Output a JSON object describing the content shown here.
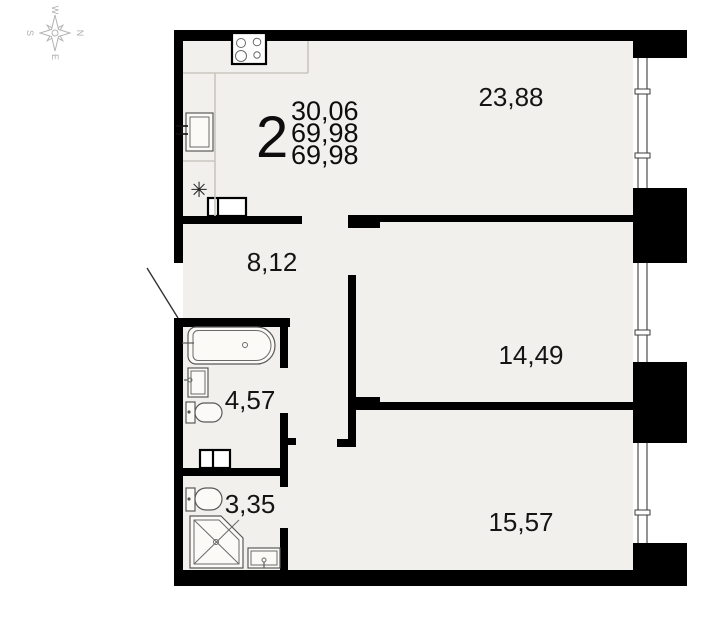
{
  "plan": {
    "title": "apartment-floor-plan",
    "apartment": {
      "rooms_count": "2",
      "living_area": "30,06",
      "total_area": "69,98",
      "total_area_with_balcony": "69,98"
    },
    "rooms": [
      {
        "id": "kitchen-living-room",
        "area": "23,88"
      },
      {
        "id": "hallway",
        "area": "8,12"
      },
      {
        "id": "bedroom-1",
        "area": "14,49"
      },
      {
        "id": "bedroom-2",
        "area": "15,57"
      },
      {
        "id": "bathroom",
        "area": "4,57"
      },
      {
        "id": "wc-shower-room",
        "area": "3,35"
      }
    ],
    "kitchen": {
      "fridge_symbol": "✳"
    },
    "compass": {
      "north": "N",
      "south": "S",
      "west": "W",
      "east": "E"
    },
    "colors": {
      "wall": "#000000",
      "floor_fill": "#f2f0ec",
      "fixture_outline": "#595959",
      "counter_line": "#c9c6bf",
      "window_line": "#3d3d3d",
      "compass": "#b3b3b3",
      "label_text": "#141414"
    }
  }
}
